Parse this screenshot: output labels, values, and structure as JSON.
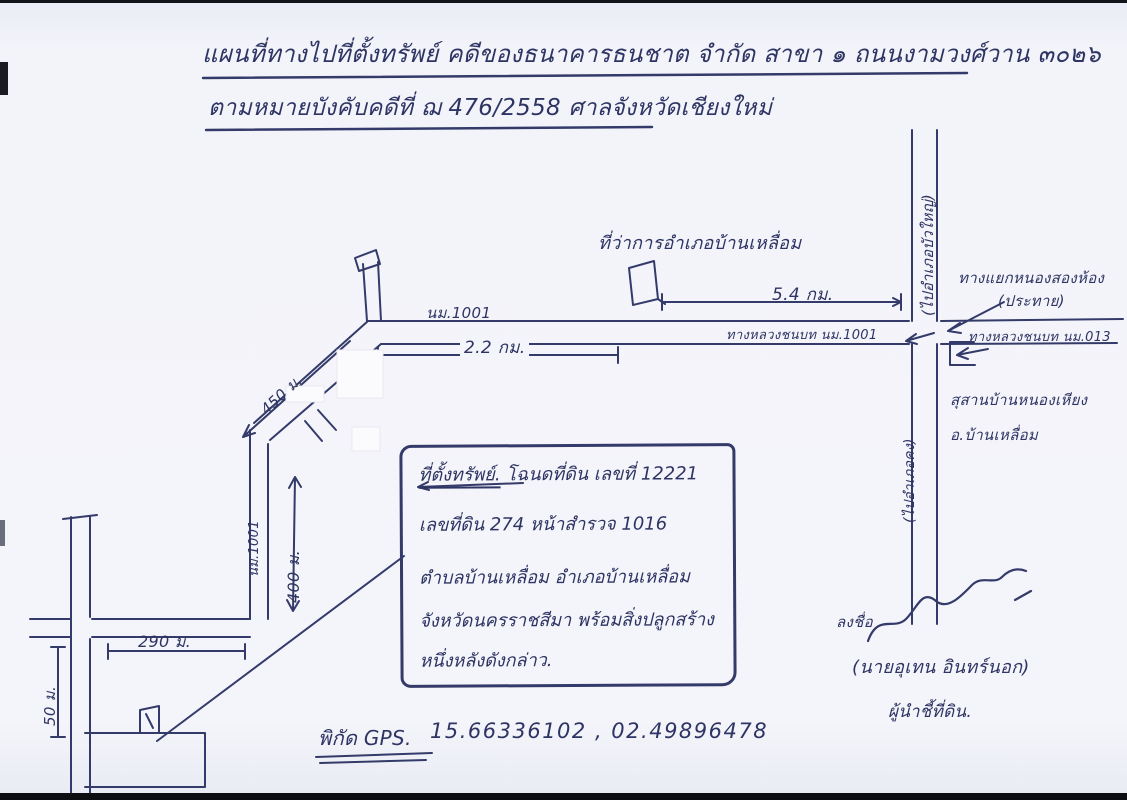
{
  "document": {
    "title_line1": "แผนที่ทางไปที่ตั้งทรัพย์ คดีของธนาคารธนชาต จำกัด สาขา ๑ ถนนงามวงศ์วาน ๓๐๒๖",
    "title_line2": "ตามหมายบังคับคดีที่ ฌ 476/2558 ศาลจังหวัดเชียงใหม่"
  },
  "map": {
    "district_office_label": "ที่ว่าการอำเภอบ้านเหลื่อม",
    "distance_to_office": "5.4 กม.",
    "highway_label_left": "นม.1001",
    "distance_main_road": "2.2 กม.",
    "main_road_label": "ทางหลวงชนบท นม.1001",
    "north_direction_label": "(ไปอำเภอบัวใหญ่)",
    "junction_label_line1": "ทางแยกหนองสองห้อง",
    "junction_label_line2": "(ประทาย)",
    "east_road_label": "ทางหลวงชนบท นม.013",
    "south_direction_label": "(ไปอำเภอคง)",
    "cemetery_label_line1": "สุสานบ้านหนองเหียง",
    "cemetery_label_line2": "อ.บ้านเหลื่อม",
    "distance_diagonal": "450 ม.",
    "vertical_road_label": "นม.1001",
    "distance_vertical": "400 ม.",
    "distance_bottom": "290 ม.",
    "distance_left": "50 ม."
  },
  "info_box": {
    "line1_title": "ที่ตั้งทรัพย์.",
    "line1_rest": "โฉนดที่ดิน เลขที่ 12221",
    "line2": "เลขที่ดิน 274 หน้าสำรวจ 1016",
    "line3": "ตำบลบ้านเหลื่อม อำเภอบ้านเหลื่อม",
    "line4": "จังหวัดนครราชสีมา พร้อมสิ่งปลูกสร้าง",
    "line5": "หนึ่งหลังดังกล่าว."
  },
  "footer": {
    "gps_label": "พิกัด GPS.",
    "gps_value": "15.66336102 , 02.49896478"
  },
  "signature": {
    "prefix": "ลงชื่อ",
    "name": "(นายอุเทน อินทร์นอก)",
    "role": "ผู้นำชี้ที่ดิน."
  },
  "colors": {
    "ink": "#343a69",
    "paper": "#f4f5fa"
  }
}
